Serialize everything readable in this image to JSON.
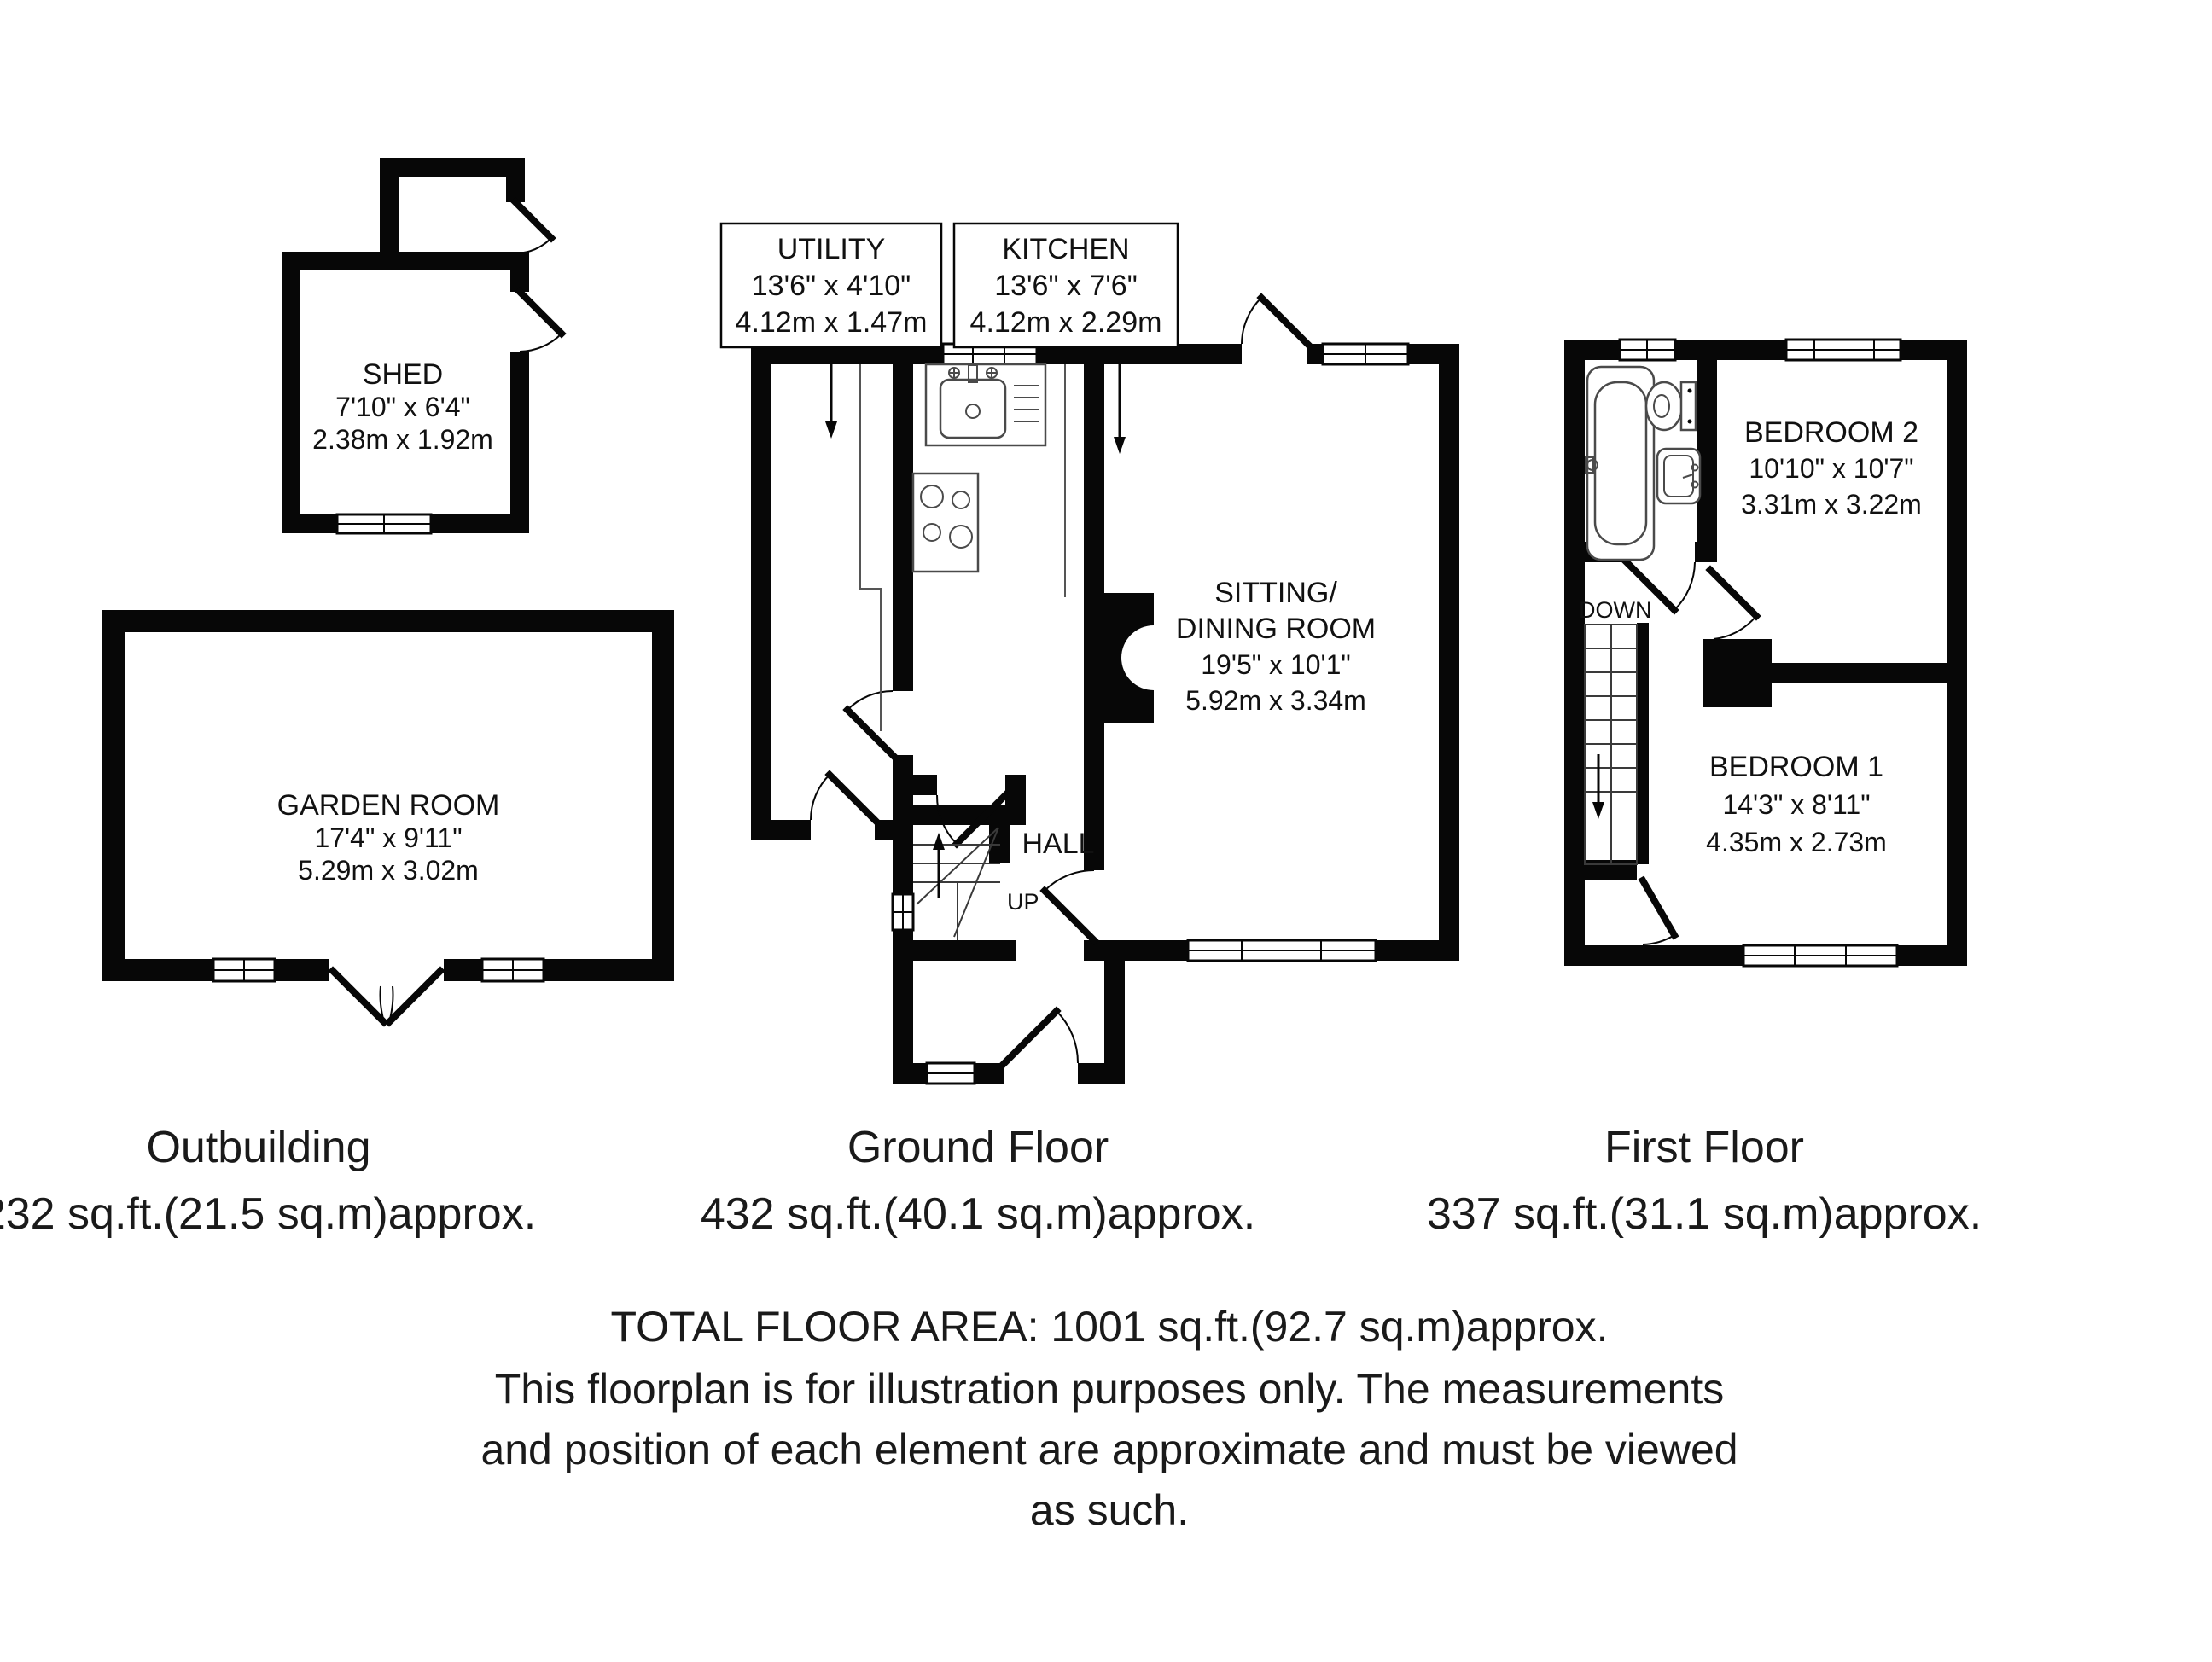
{
  "page": {
    "background": "#ffffff",
    "ink": "#070707"
  },
  "plans": {
    "outbuilding": {
      "caption_title": "Outbuilding",
      "caption_area": "232 sq.ft.(21.5 sq.m)approx.",
      "shed": {
        "name": "SHED",
        "size_imperial": "7'10\" x 6'4\"",
        "size_metric": "2.38m x 1.92m"
      },
      "garden_room": {
        "name": "GARDEN ROOM",
        "size_imperial": "17'4\" x 9'11\"",
        "size_metric": "5.29m x 3.02m"
      }
    },
    "ground_floor": {
      "caption_title": "Ground Floor",
      "caption_area": "432 sq.ft.(40.1 sq.m)approx.",
      "utility": {
        "name": "UTILITY",
        "size_imperial": "13'6\" x 4'10\"",
        "size_metric": "4.12m x 1.47m"
      },
      "kitchen": {
        "name": "KITCHEN",
        "size_imperial": "13'6\" x 7'6\"",
        "size_metric": "4.12m x 2.29m"
      },
      "sitting_dining": {
        "name_line1": "SITTING/",
        "name_line2": "DINING ROOM",
        "size_imperial": "19'5\" x 10'1\"",
        "size_metric": "5.92m x 3.34m"
      },
      "hall_label": "HALL",
      "stairs_direction": "UP"
    },
    "first_floor": {
      "caption_title": "First Floor",
      "caption_area": "337 sq.ft.(31.1 sq.m)approx.",
      "bedroom_2": {
        "name": "BEDROOM 2",
        "size_imperial": "10'10\" x 10'7\"",
        "size_metric": "3.31m x 3.22m"
      },
      "bedroom_1": {
        "name": "BEDROOM 1",
        "size_imperial": "14'3\" x 8'11\"",
        "size_metric": "4.35m x 2.73m"
      },
      "stairs_direction": "DOWN"
    }
  },
  "footer": {
    "total_area": "TOTAL FLOOR AREA: 1001 sq.ft.(92.7 sq.m)approx.",
    "disclaimer_line1": "This floorplan is for illustration purposes only. The measurements",
    "disclaimer_line2": "and position of each element are approximate and must be viewed",
    "disclaimer_line3": "as such."
  }
}
